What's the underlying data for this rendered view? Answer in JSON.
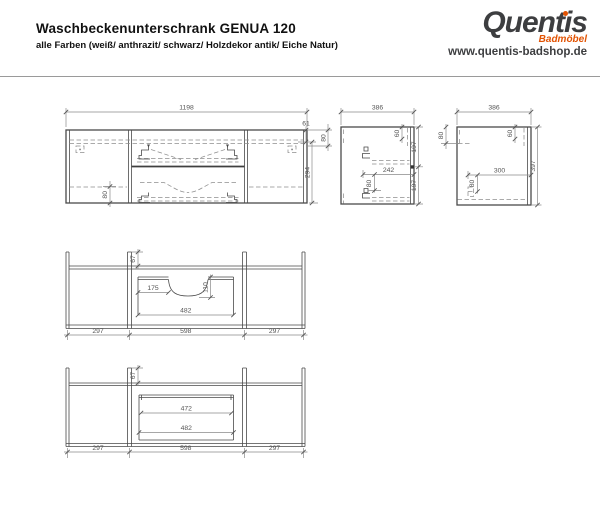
{
  "header": {
    "title": "Waschbeckenunterschrank GENUA 120",
    "subtitle": "alle Farben (weiß/ anthrazit/ schwarz/ Holzdekor antik/ Eiche Natur)",
    "logo": {
      "brand": "Quentis",
      "tagline": "Badmöbel",
      "website": "www.quentis-badshop.de"
    },
    "colors": {
      "brand_gray": "#3d3e40",
      "brand_orange": "#e25303"
    }
  },
  "views": {
    "front": {
      "width": "1198",
      "top_edge": "61",
      "top_offset": "80",
      "height": "294",
      "plinth": "80"
    },
    "side_left": {
      "width": "386",
      "top_right": "60",
      "upper": "197",
      "lower": "197",
      "depth": "242",
      "hinge_offset": "80"
    },
    "side_right": {
      "width": "386",
      "top_left": "80",
      "top_right": "60",
      "depth": "300",
      "hinge_offset": "80",
      "height": "397"
    },
    "plan_top": {
      "rail": "67",
      "cutout_offset": "175",
      "cutout_depth": "110",
      "drawer_width": "482",
      "left": "297",
      "middle": "598",
      "right": "297"
    },
    "plan_bottom": {
      "rail": "67",
      "inner_width": "472",
      "drawer_width": "482",
      "left": "297",
      "middle": "598",
      "right": "297"
    }
  }
}
